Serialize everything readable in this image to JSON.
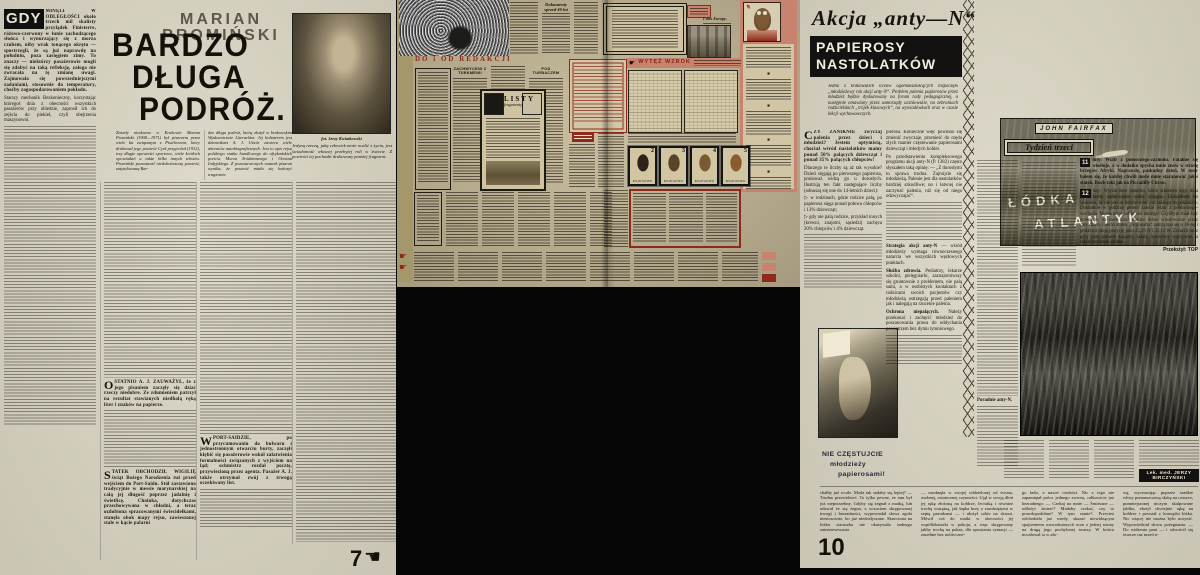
{
  "icons": {
    "hand_right": "☛",
    "hand_left": "☚",
    "separator": "✱"
  },
  "page_left": {
    "page_number": "7",
    "kicker": "MARIAN PROMIŃSKI",
    "title_line1": "BARDZO",
    "title_line2": "DŁUGA",
    "title_line3": "PODRÓŻ.",
    "lead_word": "GDY",
    "col1_para1": "MINĘLI W ODLEGŁOŚCI około trzech mil skalisty przylądek Finisterre, różowo-czerwony w łunie zachodzącego słońca i wynurzający się z morza czubem, niby wrak tonącego okrętu — spostrzegli, że są już naprawdę na południu, poza zasięgiem zimy. To znaczy — niektórzy pasażerowie mogli się zdobyć na taką refleksję, załoga nie zwracała na tę zmianę uwagi. Zajmowała się powszedniejszymi zadaniami, stosownie do temperatury, choćby zagospodarowaniem pokładu.",
    "col1_para2": "Starszy mechanik Bezkonieczny, korzystając któregoś dnia z obecności wszystkich pasażerów przy obiedzie, zaprosił ich do zejścia do piekieł, czyli obejrzenia maszynowni.",
    "intro_col_a": "Zmarły niedawno w Krakowie Marian Promiński (1908—1971) był pisarzem przez wiele lat związanym z Piotrkowem, który drukował jego powieść Cyrk przyjechał (1932), trzy długie opowieści sportowe, wiele krótkich opowiadań a także kilka innych tekstów. Promiński pozostawił niedokończoną powieść, zatytułowaną Bar-",
    "intro_col_b": "dzo długa podróż, którą złożył w krakowskim Wydawnictwie Literackim. Jej bohaterem jest dziennikarz A. J. Utwór zawiera wiele akcentów autobiograficznych. Jest to opis rejsu polskiego statku handlowego do afrykańskich portów Morza Śródziemnego i Oceanu Indyjskiego. Z pozostawionych notatek pisarza wynika, że powieść miała się kończyć tragicznie.",
    "photo_caption": "fot. Jerzy Kwiatkowski",
    "photo_note": "Jedyną rzeczą, jaką człowiek może ocalić z życia, jest świadomość własnej przebytej roli w świecie. Z powieści tej pochodzi drukowany poniżej fragment.",
    "sec1_drop": "O",
    "sec1_text": "STATNIO A. J. ZAUWAŻYŁ, że z jego pisaniem zaczęły się dziać rzeczy niedobre. Ze zdumieniem patrzył na rezultat stawianych niedbałą ręką liter i znaków na papierze.",
    "sec2_drop": "S",
    "sec2_text": "TATEK OBCHODZIŁ WIGILIĘ świąt Bożego Narodzenia tuż przed wejściem do Port-Saidu. Stół zastawiono tradycyjnie w messie marynarskiej na całą jej długość poprzez jadalnię i świetlicę. Choinka, dotychczas przechowywana w chłodni, a teraz ozdobiona spracowanymi świecidełkami, stanęła obok mapy rejsu, zawieszonej stale w kącie palarni",
    "sec3_drop": "W",
    "sec3_text": "PORT-SAIDZIE, po przycumowaniu do bulwaru i jednostronnym otwarciu burty, zaczęli kłębić się pasażerowie wokół załatwienia formalności związanych z wyjściem na ląd; ochmistrz rozdał pocztę, przywiezioną przez agenta. Pasażer A. J. także otrzymał zwój z trwogą oczekiwany list."
  },
  "spread": {
    "header": "DO i OD REDAKCJI",
    "headline_turkmenia": "ZACHWYCENI Z TURKMENII",
    "headline_turbacz": "POD TURBACZEM",
    "headline_dokumenty": "Dokumenty sprzed 40 lat",
    "headline_dno_europy": "I dno Europy.",
    "listy_title": "LISTY",
    "listy_sub": "fragmenty",
    "wytez_wzrok": "WYTĘŻ WZROK",
    "stamps": {
      "values": [
        "2",
        "3",
        "4",
        "5"
      ],
      "country": "БЪЛГАРИЯ"
    }
  },
  "page_right": {
    "page_number": "10",
    "kicker": "Akcja „anty—N“",
    "box_line1": "PAPIEROSY",
    "box_line2": "NASTOLATKÓW",
    "intro": "Jedno z krakowskich liceów ogólnokształcących rozpoczęło „młodzieżowy rok akcji anty-N“. Problem palenia papierosów przez młodzież będzie dyskutowany na forum rady pedagogicznej, a następnie omawiany przez samorządy uczniowskie, na zebraniach rodzicielskich „trójek klasowych“, na wywiadówkach oraz w czasie lekcji wychowawczych.",
    "col1_drop": "C",
    "col1_para1": "ZY ZANIKNIE zwyczaj palenia przez dzieci i młodzież? Jestem optymistą, chociaż wśród nastolatków mamy ponad 50% palących dziewcząt i ponad 35% palących chłopców!",
    "col1_para2": "Dlaczego te liczby są aż tak wysokie? Dzieci sięgają po pierwszego papierosa, ponieważ widzą go u dorosłych. Ilustrują ten fakt następujące liczby (odnoszą się one do 14-letnich dzieci):",
    "bullet1": "w rodzinach, gdzie rodzice palą, po papierosa sięga ponad połowa chłopców i 13% dziewcząt;",
    "bullet2": "gdy nie palą rodzice, przykład innych (krewni, znajomi, sąsiedzi) zachęca 20% chłopców i 4% dziewcząt.",
    "col2_para1": "pierosa. Konieczne więc powinno się zmienić zwyczaje, przenieść do rzędu złych manier częstowanie papierosami dziewcząt i młodych kobiet.",
    "col2_para2": "Po przedstawieniu kompleksowego programu akcji anty-N (P. 1382) często słyszałem taką opinię: — „Z dorosłymi to sprawa trudna. Zajmijcie się młodzieżą. Palenie jest dla nastolatków bardziej szkodliwe; no i łatwiej nie zaczynać palenia, niż się od niego odzwyczajać“.",
    "subhead_strategia": "Strategia akcji anty-N",
    "strategia_text": "— wśród młodzieży wymaga równoczesnego natarcia we wszystkich węzłowych punktach.",
    "subhead_sluzba": "Służba zdrowia.",
    "sluzba_text": "Pediatrzy, lekarze szkolni, pielęgniarki, zaznajomiwszy się gruntownie z problemem, nie palą sami, a w osobistych kontaktach z rodzicami swoich pacjentów czy młodzieżą ostrzegają przed paleniem jak i nalegają na rzucenie palenia.",
    "subhead_ochrona": "Ochrona niepalących.",
    "ochrona_text": "Należy przekonać i zachęcić młodzież do poszanowania prawa do oddychania powietrzem bez dymu tytoniowego.",
    "subhead_poradnie": "Poradnie anty-N.",
    "slogan_line1": "NIE CZĘSTUJCIE",
    "slogan_line2": "młodzieży",
    "slogan_line3": "papierosami!",
    "credit": "Lek. med. JERZY BIRCZYŃSKI",
    "fairfax": {
      "author": "JOHN FAIRFAX",
      "title_line1": "ŁÓDKA",
      "title_line2": "ATLANTYK",
      "week_box": "Tydzień trzeci",
      "entry11_num": "11",
      "entry11_text": "luty: Wiatr z północnego-zachodu. Fatalnie się wiosłuje, a w dodatku spycha mnie znów w stronę brzegów Afryki. Naprawdę, paskudny dzień. W nocy bałem się, że każdej chwili może mnie staranować jakiś statek. Ruch taki jak na Piccadilly Circus.",
      "entry12_num": "12",
      "entry12_text": "luty: Wyrzuciłem lusterko, które stłukłem tego dnia kiedy naderwałem sobie ścięgno. Doszedłem do wniosku, że nie jest za dobrze mieć coś takiego na pokładzie. Dokładnie w godzinę potem zawiał wiatr z północnego-wschodu. Wyobraźcie sobie coś takiego! Czyżbym miał być przesądny na stare lata? Bardzo dobre wiosłowanie przez cały dzień. Grecki statek „Argonafta“ zatrzymał się o 18-tej i podał mi moją pozycję jako 25,29 N i 35,11 W. Zrzucili mi z góry parę główek kapusty, sałatę, konserwy warzywne, a także bochenek chleba.",
      "translator": "Przełożył: TOP"
    },
    "bottom_col1": "chałby już wcale. Moda tak stałaby się lepiej? — Trudno przewidzieć. To tylko pewne, że tam był już niepotrzebny. Gdyby się żegnał z matką, lub udawał że się żegna, z uczuciem skrępowanej trwogi i bezradności, wypowiadał słowa zgoła niestosowne, bo już niedosłyszane. Skurczona na łóżku staruszka nie okazywała żadnego zainteresowania",
    "bottom_col2": "— mruknęła w swojej oddzielonej od świata, osobnej, ostatecznej czynności. Ujął w swoją dłoń jej rękę złożoną na kołdrze, leciutką i również trochę wstrętną, jak łapka kury z zarośniętymi w sepię pazurkami — i ułożył sobie na skroni. Mówił coś do matki w obecności jej współlokatorki w pokoju, a więc skrępowany jakby trochę na pokaz, dla sprostania sytuacji — zupełnie bez polityczne-",
    "bottom_col3": "go ładu, a nawet czułości. Nic z tego nie zapamiętał prócz jednego zwrotu, całkowicie już bezradnego: — Czekaj na mnie — Śmieszne — odłożyć śmierć? Miałaby czekać, czy to prawdopodobne? W tym stanie?. Przecież odchodziła już wtedy, skazać niewidzącym spojrzeniem rozwodnionych oczu z jednej strony na drugą jego pochylonej twarzy. W końcu pocałował ją w gło-",
    "bottom_col4": "wę, wyczuwając poprzez rzadkie włosy pomarszczoną skórę na czaszce, pomniejszonej niczym skalpowane jabłko, złożył chwiejnie rękę na kołdrze i powstał z krawędzi łóżka. Nic więcej nie można było uczynić. Wypowiedział słowa pożegnania: — Do widzenia pani — i odwrócił się jeszcze raz przed u-"
  }
}
